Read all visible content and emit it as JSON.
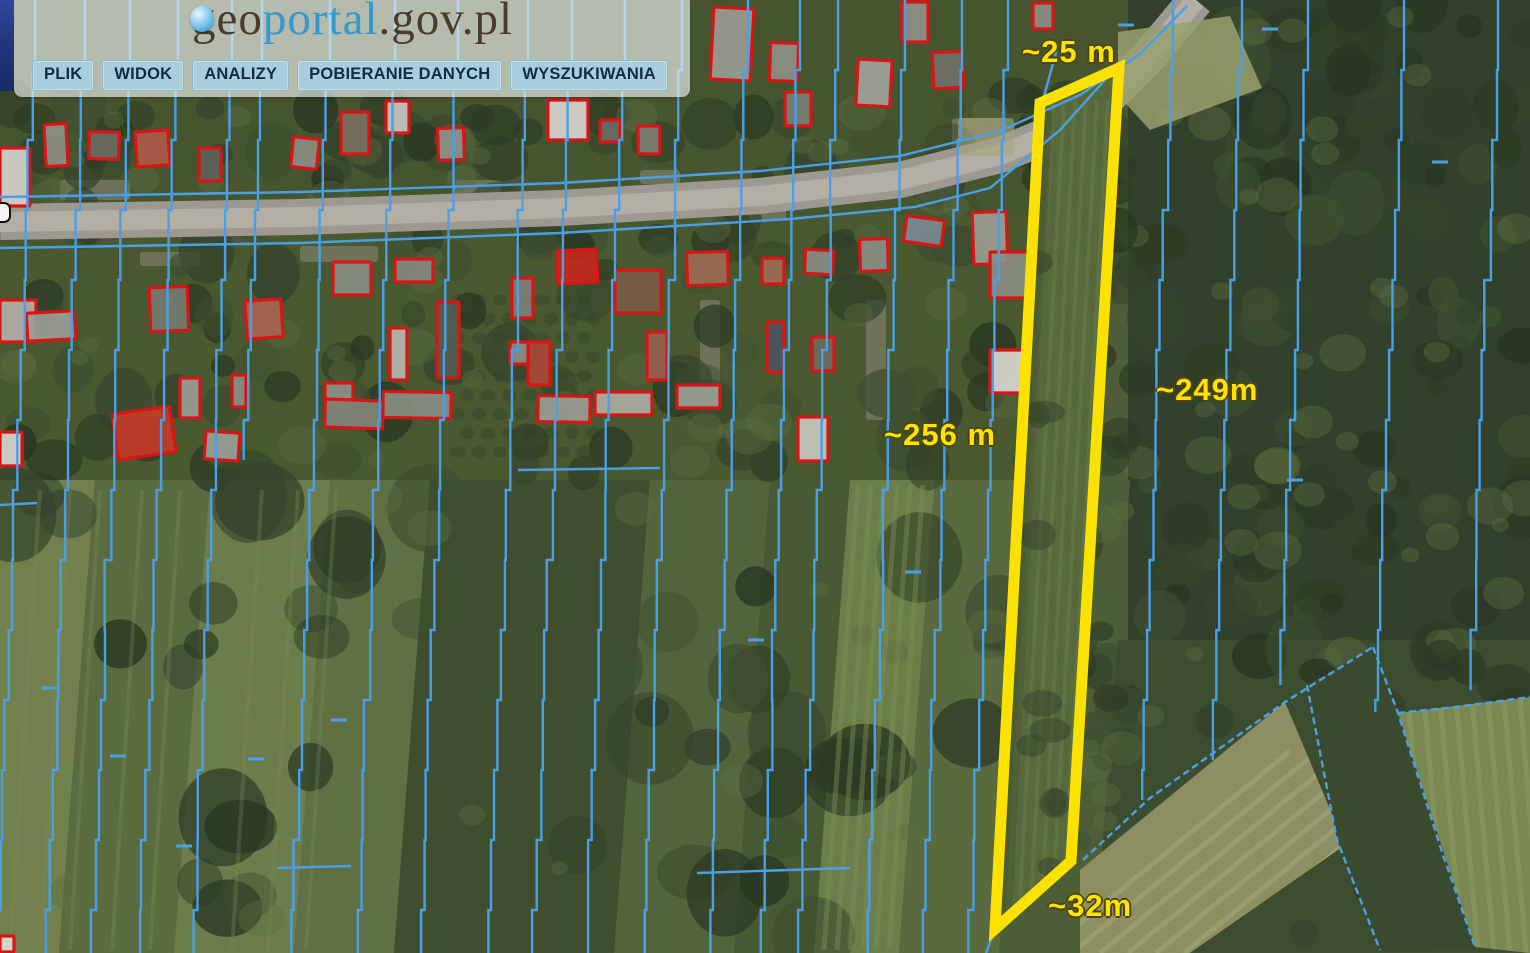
{
  "header": {
    "logo": {
      "prefix": "geo",
      "highlight": "portal",
      "suffix": ".gov.pl"
    },
    "menu": [
      {
        "label": "PLIK"
      },
      {
        "label": "WIDOK"
      },
      {
        "label": "ANALIZY"
      },
      {
        "label": "POBIERANIE DANYCH"
      },
      {
        "label": "WYSZUKIWANIA"
      }
    ]
  },
  "map": {
    "labels": [
      {
        "id": "top-width",
        "text": "~25 m"
      },
      {
        "id": "right-length",
        "text": "~249m"
      },
      {
        "id": "left-length",
        "text": "~256 m"
      },
      {
        "id": "bottom-width",
        "text": "~32m"
      }
    ]
  },
  "colors": {
    "parcel_highlight": "#fbe203",
    "cadastral_line": "#4aa0e6",
    "building_outline": "#d81414",
    "label_text": "#ffe400",
    "menu_button_bg": "#a9cede",
    "menu_text": "#122c40",
    "logo_brown": "#4c3b2a",
    "logo_blue": "#3399cf",
    "sidebar_navy": "#24367c",
    "road_gray": "#a5a197"
  }
}
